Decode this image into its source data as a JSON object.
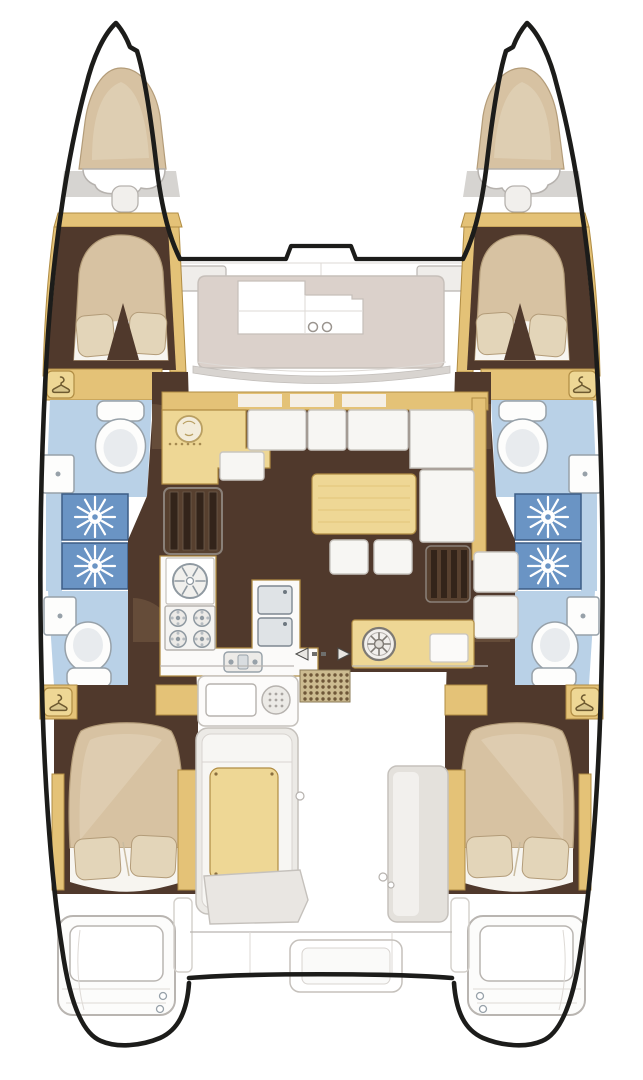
{
  "figure": {
    "kind": "catamaran-floor-plan",
    "view": "top-down",
    "description": "Top-down floor plan of a four-cabin sailing catamaran showing two hulls with forward and aft double cabins, four bathrooms with showers, central salon with L-shaped sofa and table, U-shaped galley with stove and sinks, forward lounging deck, aft cockpit with benches and wet bar, and twin swim platforms",
    "features": {
      "hulls": 2,
      "cabins": 4,
      "double_berths": 4,
      "bow_peak_berths": 2,
      "bathrooms": 4,
      "shower_stalls": 4,
      "toilets": 4,
      "washbasins": 4,
      "wardrobes": 4,
      "stove_burners": 4,
      "companionway_stairs": 2,
      "salon_stools": 2,
      "swim_platforms": 2
    }
  },
  "icons": [
    {
      "name": "shower-head-icon",
      "shape": "white sunburst on blue tile",
      "count": 4
    },
    {
      "name": "wardrobe-hanger-icon",
      "shape": "clothes hanger in rounded square",
      "count": 4
    },
    {
      "name": "toilet-icon",
      "shape": "oval bowl with cistern",
      "count": 4
    },
    {
      "name": "washbasin-icon",
      "shape": "small square basin with drain dot",
      "count": 4
    },
    {
      "name": "round-sink-icon",
      "shape": "circle with radial spokes",
      "count": 1
    },
    {
      "name": "stove-icon",
      "shape": "four burner rings",
      "count": 1
    },
    {
      "name": "double-sink-icon",
      "shape": "two rectangular basins",
      "count": 1
    },
    {
      "name": "galley-faucet-icon",
      "shape": "small sink with two knobs",
      "count": 1
    },
    {
      "name": "grill-icon",
      "shape": "dotted circle on wet bar",
      "count": 1
    },
    {
      "name": "wheel-sink-icon",
      "shape": "spoked wheel on aft counter",
      "count": 1
    },
    {
      "name": "sliding-door-arrows-icon",
      "shape": "opposing triangles with dashes",
      "count": 1
    },
    {
      "name": "teak-grate-icon",
      "shape": "dot-grid square",
      "count": 1
    },
    {
      "name": "cup-holders-icon",
      "shape": "two small circles on foredeck",
      "count": 1
    },
    {
      "name": "swim-ladder-icon",
      "shape": "two small circles on transom",
      "count": 2
    }
  ],
  "colors": {
    "paper": "#ffffff",
    "hull_outline": "#1c1c1a",
    "deck_line": "#b9b5b1",
    "deck_panel": "#efedea",
    "windshield": "#d8d4d0",
    "foredeck_pad": "#dbd1cb",
    "wood": "#e4c277",
    "wood_light": "#eed795",
    "wood_edge": "#b08c43",
    "berth": "#d7c2a2",
    "berth_edge": "#b39c79",
    "pillow": "#e3d5b9",
    "sheet": "#f7f5f0",
    "floor_brown": "#50392c",
    "swing": "#8a6b50",
    "bath_blue": "#b9d1e7",
    "shower_blue": "#6a94c4",
    "shower_edge": "#3c5d85",
    "fixture": "#fdfdfc",
    "fixture_edge": "#97a1a9",
    "cushion": "#f7f6f3",
    "cushion_edge": "#c9c5c0",
    "grate": "#ccbb90",
    "grate_dot": "#6f5738",
    "steel_fill": "#dfe3e6",
    "steel_edge": "#7e8891"
  }
}
